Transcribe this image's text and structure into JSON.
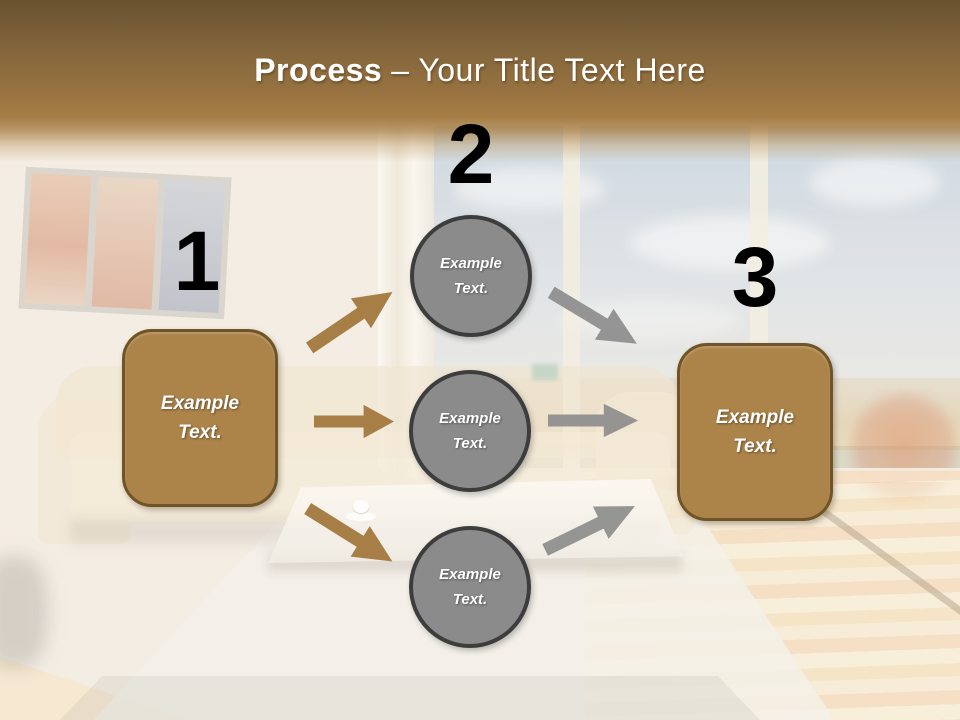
{
  "title": {
    "bold": "Process",
    "regular": "– Your Title Text Here"
  },
  "diagram": {
    "numbers": [
      "1",
      "2",
      "3"
    ],
    "left_box_label": "Example Text.",
    "right_box_label": "Example Text.",
    "circle_labels": [
      "Example Text.",
      "Example Text.",
      "Example Text."
    ]
  },
  "colors": {
    "header_brown_dark": "#6a5230",
    "header_brown_light": "#a57d45",
    "box_fill": "#ac8349",
    "box_border": "#6e5426",
    "circle_fill": "#8b8b8b",
    "circle_border": "#3d3d3d",
    "arrow_brown": "#a87e47",
    "arrow_gray": "#8f8f8f",
    "title_color": "#ffffff",
    "number_color": "#000000"
  }
}
